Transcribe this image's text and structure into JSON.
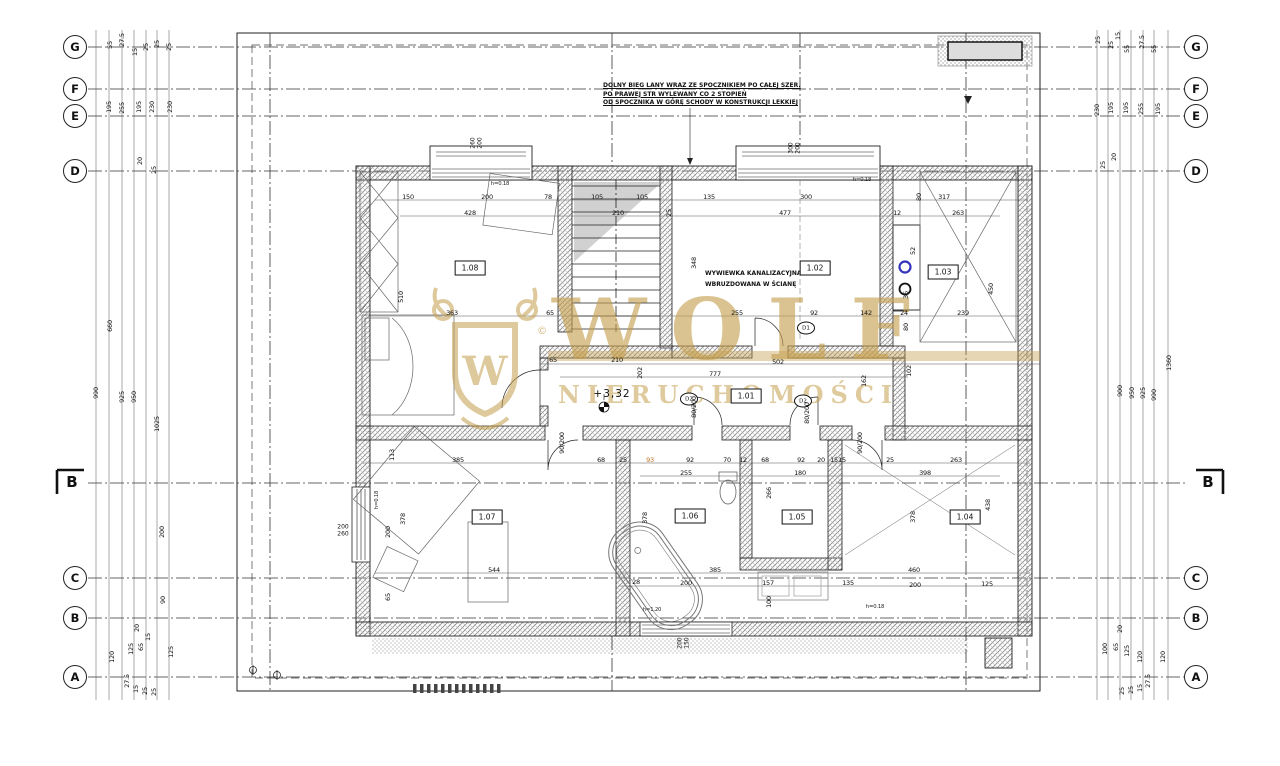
{
  "axes": {
    "section_label": "B",
    "left": [
      {
        "label": "G",
        "y": 47
      },
      {
        "label": "F",
        "y": 89
      },
      {
        "label": "E",
        "y": 116
      },
      {
        "label": "D",
        "y": 171
      },
      {
        "label": "C",
        "y": 578
      },
      {
        "label": "B",
        "y": 618
      },
      {
        "label": "A",
        "y": 677
      }
    ],
    "right": [
      {
        "label": "G",
        "y": 47
      },
      {
        "label": "F",
        "y": 89
      },
      {
        "label": "E",
        "y": 116
      },
      {
        "label": "D",
        "y": 171
      },
      {
        "label": "C",
        "y": 578
      },
      {
        "label": "B",
        "y": 618
      },
      {
        "label": "A",
        "y": 677
      }
    ]
  },
  "rooms": [
    {
      "id": "1.08",
      "x": 470,
      "y": 268
    },
    {
      "id": "1.02",
      "x": 815,
      "y": 268
    },
    {
      "id": "1.03",
      "x": 943,
      "y": 272
    },
    {
      "id": "1.01",
      "x": 746,
      "y": 396
    },
    {
      "id": "1.07",
      "x": 487,
      "y": 517
    },
    {
      "id": "1.06",
      "x": 690,
      "y": 516
    },
    {
      "id": "1.05",
      "x": 797,
      "y": 517
    },
    {
      "id": "1.04",
      "x": 965,
      "y": 517
    }
  ],
  "doors": [
    {
      "tag": "D2",
      "x": 689,
      "y": 399
    },
    {
      "tag": "D2",
      "x": 803,
      "y": 401
    },
    {
      "tag": "D1",
      "x": 806,
      "y": 328
    }
  ],
  "windows": [
    {
      "size": "260/200",
      "x": 477,
      "y": 143,
      "rot": true
    },
    {
      "size": "300/200",
      "x": 795,
      "y": 148,
      "rot": true
    },
    {
      "size": "200/260",
      "x": 343,
      "y": 531,
      "rot": false
    },
    {
      "size": "200/150",
      "x": 684,
      "y": 643,
      "rot": true
    }
  ],
  "notes": {
    "stair": [
      "DOLNY BIEG LANY WRAZ ZE SPOCZNIKIEM PO CAŁEJ SZER.",
      "PO PRAWEJ STR WYLEWANY CO 2 STOPIEŃ",
      "OD SPOCZNIKA W GÓRĘ SCHODY W KONSTRUKCJI LEKKIEJ"
    ],
    "vent": [
      "WYWIEWKA KANALIZACYJNA",
      "WBRUZDOWANA W ŚCIANĘ"
    ],
    "level": "+3,32"
  },
  "watermark": {
    "name": "WOLF",
    "subtitle": "NIERUCHOMOŚCI",
    "monogram": "W",
    "copyright": "©",
    "color": "#c49e4c"
  },
  "dims": [
    [
      "150",
      408,
      197,
      0
    ],
    [
      "200",
      487,
      197,
      0
    ],
    [
      "78",
      548,
      197,
      0
    ],
    [
      "105",
      597,
      197,
      0
    ],
    [
      "105",
      642,
      197,
      0
    ],
    [
      "135",
      709,
      197,
      0
    ],
    [
      "300",
      806,
      197,
      0
    ],
    [
      "80",
      919,
      197,
      1
    ],
    [
      "317",
      944,
      197,
      0
    ],
    [
      "428",
      470,
      213,
      0
    ],
    [
      "210",
      618,
      213,
      0
    ],
    [
      "25",
      669,
      213,
      1
    ],
    [
      "477",
      785,
      213,
      0
    ],
    [
      "12",
      897,
      213,
      0
    ],
    [
      "263",
      958,
      213,
      0
    ],
    [
      "h=0.18",
      500,
      184,
      0,
      "sm"
    ],
    [
      "h=0.18",
      862,
      180,
      0,
      "sm"
    ],
    [
      "510",
      401,
      297,
      1
    ],
    [
      "363",
      452,
      313,
      0
    ],
    [
      "65",
      550,
      313,
      0
    ],
    [
      "255",
      737,
      313,
      0
    ],
    [
      "92",
      814,
      313,
      0
    ],
    [
      "142",
      866,
      313,
      0
    ],
    [
      "24",
      904,
      313,
      0
    ],
    [
      "239",
      963,
      313,
      0
    ],
    [
      "348",
      694,
      263,
      1
    ],
    [
      "52",
      913,
      251,
      1
    ],
    [
      "36",
      906,
      295,
      1
    ],
    [
      "80",
      906,
      327,
      1
    ],
    [
      "450",
      991,
      289,
      1
    ],
    [
      "102",
      909,
      371,
      1
    ],
    [
      "65",
      553,
      360,
      0
    ],
    [
      "210",
      617,
      360,
      0
    ],
    [
      "502",
      778,
      362,
      0
    ],
    [
      "777",
      715,
      374,
      0
    ],
    [
      "202",
      640,
      373,
      1
    ],
    [
      "162",
      864,
      381,
      1
    ],
    [
      "80/200",
      694,
      407,
      1
    ],
    [
      "80/200",
      807,
      413,
      1
    ],
    [
      "90/200",
      562,
      443,
      1
    ],
    [
      "90/200",
      860,
      443,
      1
    ],
    [
      "113",
      392,
      455,
      1
    ],
    [
      "385",
      458,
      460,
      0
    ],
    [
      "68",
      601,
      460,
      0
    ],
    [
      "25",
      623,
      460,
      0
    ],
    [
      "93",
      650,
      460,
      0,
      "hl"
    ],
    [
      "92",
      690,
      460,
      0
    ],
    [
      "70",
      727,
      460,
      0
    ],
    [
      "12",
      743,
      460,
      0
    ],
    [
      "68",
      765,
      460,
      0
    ],
    [
      "92",
      801,
      460,
      0
    ],
    [
      "20",
      821,
      460,
      0
    ],
    [
      "15",
      834,
      460,
      0
    ],
    [
      "15",
      842,
      460,
      0
    ],
    [
      "25",
      890,
      460,
      0
    ],
    [
      "263",
      956,
      460,
      0
    ],
    [
      "255",
      686,
      473,
      0
    ],
    [
      "180",
      800,
      473,
      0
    ],
    [
      "398",
      925,
      473,
      0
    ],
    [
      "378",
      403,
      519,
      1
    ],
    [
      "200",
      388,
      532,
      1
    ],
    [
      "544",
      494,
      570,
      0
    ],
    [
      "65",
      388,
      597,
      1
    ],
    [
      "h=0.18",
      377,
      500,
      1,
      "sm"
    ],
    [
      "266",
      769,
      493,
      1
    ],
    [
      "378",
      645,
      518,
      1
    ],
    [
      "378",
      913,
      517,
      1
    ],
    [
      "438",
      988,
      505,
      1
    ],
    [
      "385",
      715,
      570,
      0
    ],
    [
      "460",
      914,
      570,
      0
    ],
    [
      "28",
      636,
      582,
      0
    ],
    [
      "200",
      686,
      583,
      0
    ],
    [
      "157",
      768,
      583,
      0
    ],
    [
      "135",
      848,
      583,
      0
    ],
    [
      "200",
      915,
      585,
      0
    ],
    [
      "125",
      987,
      584,
      0
    ],
    [
      "100",
      769,
      602,
      1
    ],
    [
      "h=1.20",
      652,
      610,
      0,
      "sm"
    ],
    [
      "h=0.18",
      875,
      607,
      0,
      "sm"
    ],
    [
      "55",
      110,
      45,
      1
    ],
    [
      "27.5",
      122,
      40,
      1
    ],
    [
      "15",
      135,
      52,
      1
    ],
    [
      "25",
      146,
      47,
      1
    ],
    [
      "25",
      157,
      44,
      1
    ],
    [
      "25",
      169,
      47,
      1
    ],
    [
      "195",
      109,
      107,
      1
    ],
    [
      "255",
      122,
      108,
      1
    ],
    [
      "195",
      139,
      107,
      1
    ],
    [
      "230",
      152,
      107,
      1
    ],
    [
      "230",
      170,
      107,
      1
    ],
    [
      "20",
      140,
      161,
      1
    ],
    [
      "25",
      154,
      170,
      1
    ],
    [
      "660",
      110,
      326,
      1
    ],
    [
      "990",
      96,
      393,
      1
    ],
    [
      "925",
      122,
      397,
      1
    ],
    [
      "950",
      134,
      397,
      1
    ],
    [
      "1025",
      157,
      424,
      1
    ],
    [
      "200",
      162,
      532,
      1
    ],
    [
      "90",
      163,
      600,
      1
    ],
    [
      "120",
      112,
      657,
      1
    ],
    [
      "125",
      131,
      649,
      1
    ],
    [
      "65",
      141,
      647,
      1
    ],
    [
      "20",
      137,
      628,
      1
    ],
    [
      "15",
      148,
      637,
      1
    ],
    [
      "125",
      171,
      652,
      1
    ],
    [
      "27.5",
      127,
      681,
      1
    ],
    [
      "15",
      136,
      689,
      1
    ],
    [
      "25",
      145,
      691,
      1
    ],
    [
      "25",
      154,
      692,
      1
    ],
    [
      "25",
      1098,
      40,
      1
    ],
    [
      "25",
      1111,
      45,
      1
    ],
    [
      "15",
      1118,
      36,
      1
    ],
    [
      "55",
      1127,
      49,
      1
    ],
    [
      "27.5",
      1142,
      42,
      1
    ],
    [
      "55",
      1154,
      49,
      1
    ],
    [
      "230",
      1097,
      110,
      1
    ],
    [
      "195",
      1111,
      108,
      1
    ],
    [
      "195",
      1126,
      108,
      1
    ],
    [
      "255",
      1141,
      109,
      1
    ],
    [
      "195",
      1158,
      109,
      1
    ],
    [
      "20",
      1114,
      157,
      1
    ],
    [
      "25",
      1103,
      165,
      1
    ],
    [
      "900",
      1120,
      391,
      1
    ],
    [
      "950",
      1132,
      393,
      1
    ],
    [
      "925",
      1143,
      393,
      1
    ],
    [
      "990",
      1154,
      395,
      1
    ],
    [
      "1360",
      1169,
      363,
      1
    ],
    [
      "100",
      1105,
      649,
      1
    ],
    [
      "65",
      1116,
      647,
      1
    ],
    [
      "20",
      1120,
      629,
      1
    ],
    [
      "125",
      1127,
      651,
      1
    ],
    [
      "120",
      1140,
      657,
      1
    ],
    [
      "120",
      1163,
      657,
      1
    ],
    [
      "27.5",
      1148,
      681,
      1
    ],
    [
      "15",
      1140,
      688,
      1
    ],
    [
      "25",
      1131,
      690,
      1
    ],
    [
      "25",
      1122,
      691,
      1
    ]
  ]
}
